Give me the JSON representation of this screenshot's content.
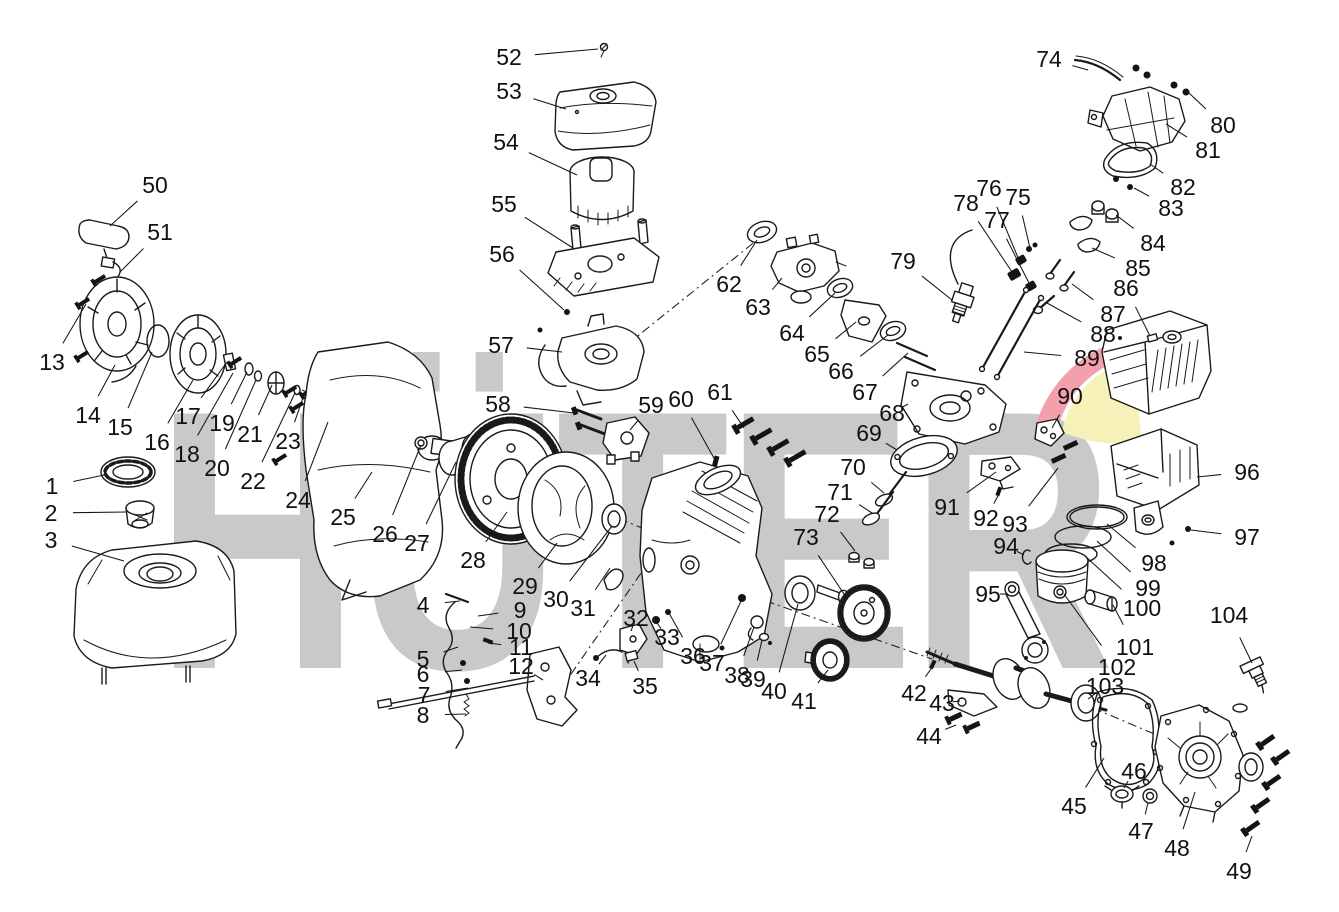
{
  "figure_type": "exploded-parts-diagram",
  "subject": "single-cylinder gasoline engine",
  "background": "#ffffff",
  "watermark": {
    "text": "HÜTER",
    "color": "#c9c9c9",
    "logo_red": "#f2a0ac",
    "logo_yellow": "#f6f1b8"
  },
  "diagram": {
    "line_color": "#1a1a1a",
    "label_font_size": 23,
    "part_count": 104,
    "parts": [
      {
        "num": "1",
        "label": [
          52,
          486
        ],
        "target": [
          104,
          475
        ]
      },
      {
        "num": "2",
        "label": [
          51,
          513
        ],
        "target": [
          127,
          512
        ]
      },
      {
        "num": "3",
        "label": [
          51,
          540
        ],
        "target": [
          124,
          561
        ]
      },
      {
        "num": "4",
        "label": [
          423,
          605
        ],
        "target": [
          460,
          601
        ]
      },
      {
        "num": "5",
        "label": [
          423,
          659
        ],
        "target": [
          458,
          647
        ]
      },
      {
        "num": "6",
        "label": [
          423,
          674
        ],
        "target": [
          462,
          670
        ]
      },
      {
        "num": "7",
        "label": [
          424,
          695
        ],
        "target": [
          468,
          688
        ]
      },
      {
        "num": "8",
        "label": [
          423,
          715
        ],
        "target": [
          466,
          714
        ]
      },
      {
        "num": "9",
        "label": [
          520,
          610
        ],
        "target": [
          478,
          616
        ]
      },
      {
        "num": "10",
        "label": [
          519,
          631
        ],
        "target": [
          470,
          627
        ]
      },
      {
        "num": "11",
        "label": [
          521,
          647
        ],
        "target": [
          488,
          643
        ]
      },
      {
        "num": "12",
        "label": [
          521,
          666
        ],
        "target": [
          543,
          680
        ]
      },
      {
        "num": "13",
        "label": [
          52,
          362
        ],
        "target": [
          86,
          304
        ]
      },
      {
        "num": "14",
        "label": [
          88,
          415
        ],
        "target": [
          115,
          365
        ]
      },
      {
        "num": "15",
        "label": [
          120,
          427
        ],
        "target": [
          152,
          352
        ]
      },
      {
        "num": "16",
        "label": [
          157,
          442
        ],
        "target": [
          193,
          380
        ]
      },
      {
        "num": "17",
        "label": [
          188,
          416
        ],
        "target": [
          227,
          362
        ]
      },
      {
        "num": "18",
        "label": [
          187,
          454
        ],
        "target": [
          233,
          373
        ]
      },
      {
        "num": "19",
        "label": [
          222,
          423
        ],
        "target": [
          247,
          372
        ]
      },
      {
        "num": "20",
        "label": [
          217,
          468
        ],
        "target": [
          256,
          380
        ]
      },
      {
        "num": "21",
        "label": [
          250,
          434
        ],
        "target": [
          272,
          385
        ]
      },
      {
        "num": "22",
        "label": [
          253,
          481
        ],
        "target": [
          295,
          393
        ]
      },
      {
        "num": "23",
        "label": [
          288,
          441
        ],
        "target": [
          305,
          392
        ]
      },
      {
        "num": "24",
        "label": [
          298,
          500
        ],
        "target": [
          328,
          422
        ]
      },
      {
        "num": "25",
        "label": [
          343,
          517
        ],
        "target": [
          372,
          472
        ]
      },
      {
        "num": "26",
        "label": [
          385,
          534
        ],
        "target": [
          421,
          445
        ]
      },
      {
        "num": "27",
        "label": [
          417,
          543
        ],
        "target": [
          456,
          462
        ]
      },
      {
        "num": "28",
        "label": [
          473,
          560
        ],
        "target": [
          507,
          512
        ]
      },
      {
        "num": "29",
        "label": [
          525,
          586
        ],
        "target": [
          557,
          543
        ]
      },
      {
        "num": "30",
        "label": [
          556,
          599
        ],
        "target": [
          612,
          526
        ]
      },
      {
        "num": "31",
        "label": [
          583,
          608
        ],
        "target": [
          610,
          568
        ]
      },
      {
        "num": "32",
        "label": [
          636,
          618
        ],
        "target": [
          631,
          631
        ]
      },
      {
        "num": "33",
        "label": [
          667,
          637
        ],
        "target": [
          657,
          623
        ]
      },
      {
        "num": "34",
        "label": [
          588,
          678
        ],
        "target": [
          606,
          655
        ]
      },
      {
        "num": "35",
        "label": [
          645,
          686
        ],
        "target": [
          634,
          661
        ]
      },
      {
        "num": "36",
        "label": [
          693,
          656
        ],
        "target": [
          669,
          613
        ]
      },
      {
        "num": "37",
        "label": [
          712,
          663
        ],
        "target": [
          742,
          599
        ]
      },
      {
        "num": "38",
        "label": [
          737,
          675
        ],
        "target": [
          754,
          627
        ]
      },
      {
        "num": "39",
        "label": [
          753,
          679
        ],
        "target": [
          762,
          640
        ]
      },
      {
        "num": "40",
        "label": [
          774,
          691
        ],
        "target": [
          798,
          604
        ]
      },
      {
        "num": "41",
        "label": [
          804,
          701
        ],
        "target": [
          828,
          670
        ]
      },
      {
        "num": "42",
        "label": [
          914,
          693
        ],
        "target": [
          933,
          666
        ]
      },
      {
        "num": "43",
        "label": [
          942,
          703
        ],
        "target": [
          960,
          701
        ]
      },
      {
        "num": "44",
        "label": [
          929,
          736
        ],
        "target": [
          956,
          725
        ]
      },
      {
        "num": "45",
        "label": [
          1074,
          806
        ],
        "target": [
          1104,
          758
        ]
      },
      {
        "num": "46",
        "label": [
          1134,
          771
        ],
        "target": [
          1124,
          788
        ]
      },
      {
        "num": "47",
        "label": [
          1141,
          831
        ],
        "target": [
          1148,
          803
        ]
      },
      {
        "num": "48",
        "label": [
          1177,
          848
        ],
        "target": [
          1195,
          792
        ]
      },
      {
        "num": "49",
        "label": [
          1239,
          871
        ],
        "target": [
          1252,
          836
        ]
      },
      {
        "num": "50",
        "label": [
          155,
          185
        ],
        "target": [
          110,
          226
        ]
      },
      {
        "num": "51",
        "label": [
          160,
          232
        ],
        "target": [
          120,
          272
        ]
      },
      {
        "num": "52",
        "label": [
          509,
          57
        ],
        "target": [
          598,
          49
        ]
      },
      {
        "num": "53",
        "label": [
          509,
          91
        ],
        "target": [
          566,
          109
        ]
      },
      {
        "num": "54",
        "label": [
          506,
          142
        ],
        "target": [
          577,
          175
        ]
      },
      {
        "num": "55",
        "label": [
          504,
          204
        ],
        "target": [
          573,
          248
        ]
      },
      {
        "num": "56",
        "label": [
          502,
          254
        ],
        "target": [
          564,
          310
        ]
      },
      {
        "num": "57",
        "label": [
          501,
          345
        ],
        "target": [
          562,
          352
        ]
      },
      {
        "num": "58",
        "label": [
          498,
          404
        ],
        "target": [
          574,
          413
        ]
      },
      {
        "num": "59",
        "label": [
          651,
          405
        ],
        "target": [
          630,
          430
        ]
      },
      {
        "num": "60",
        "label": [
          681,
          399
        ],
        "target": [
          715,
          460
        ]
      },
      {
        "num": "61",
        "label": [
          720,
          392
        ],
        "target": [
          744,
          428
        ]
      },
      {
        "num": "62",
        "label": [
          729,
          284
        ],
        "target": [
          757,
          240
        ]
      },
      {
        "num": "63",
        "label": [
          758,
          307
        ],
        "target": [
          782,
          278
        ]
      },
      {
        "num": "64",
        "label": [
          792,
          333
        ],
        "target": [
          835,
          293
        ]
      },
      {
        "num": "65",
        "label": [
          817,
          354
        ],
        "target": [
          856,
          322
        ]
      },
      {
        "num": "66",
        "label": [
          841,
          371
        ],
        "target": [
          888,
          335
        ]
      },
      {
        "num": "67",
        "label": [
          865,
          392
        ],
        "target": [
          908,
          353
        ]
      },
      {
        "num": "68",
        "label": [
          892,
          413
        ],
        "target": [
          908,
          404
        ]
      },
      {
        "num": "69",
        "label": [
          869,
          433
        ],
        "target": [
          897,
          450
        ]
      },
      {
        "num": "70",
        "label": [
          853,
          467
        ],
        "target": [
          884,
          493
        ]
      },
      {
        "num": "71",
        "label": [
          840,
          492
        ],
        "target": [
          872,
          513
        ]
      },
      {
        "num": "72",
        "label": [
          827,
          514
        ],
        "target": [
          855,
          551
        ]
      },
      {
        "num": "73",
        "label": [
          806,
          537
        ],
        "target": [
          846,
          597
        ]
      },
      {
        "num": "74",
        "label": [
          1049,
          59
        ],
        "target": [
          1088,
          70
        ]
      },
      {
        "num": "75",
        "label": [
          1018,
          197
        ],
        "target": [
          1030,
          248
        ]
      },
      {
        "num": "76",
        "label": [
          989,
          188
        ],
        "target": [
          1019,
          260
        ]
      },
      {
        "num": "77",
        "label": [
          997,
          220
        ],
        "target": [
          1029,
          283
        ]
      },
      {
        "num": "78",
        "label": [
          966,
          203
        ],
        "target": [
          1012,
          272
        ]
      },
      {
        "num": "79",
        "label": [
          903,
          261
        ],
        "target": [
          952,
          300
        ]
      },
      {
        "num": "80",
        "label": [
          1223,
          125
        ],
        "target": [
          1189,
          93
        ]
      },
      {
        "num": "81",
        "label": [
          1208,
          150
        ],
        "target": [
          1166,
          124
        ]
      },
      {
        "num": "82",
        "label": [
          1183,
          187
        ],
        "target": [
          1150,
          164
        ]
      },
      {
        "num": "83",
        "label": [
          1171,
          208
        ],
        "target": [
          1134,
          188
        ]
      },
      {
        "num": "84",
        "label": [
          1153,
          243
        ],
        "target": [
          1116,
          215
        ]
      },
      {
        "num": "85",
        "label": [
          1138,
          268
        ],
        "target": [
          1092,
          248
        ]
      },
      {
        "num": "86",
        "label": [
          1126,
          288
        ],
        "target": [
          1150,
          336
        ]
      },
      {
        "num": "87",
        "label": [
          1113,
          314
        ],
        "target": [
          1072,
          284
        ]
      },
      {
        "num": "88",
        "label": [
          1103,
          334
        ],
        "target": [
          1047,
          303
        ]
      },
      {
        "num": "89",
        "label": [
          1087,
          358
        ],
        "target": [
          1024,
          352
        ]
      },
      {
        "num": "90",
        "label": [
          1070,
          396
        ],
        "target": [
          1052,
          428
        ]
      },
      {
        "num": "91",
        "label": [
          947,
          507
        ],
        "target": [
          996,
          472
        ]
      },
      {
        "num": "92",
        "label": [
          986,
          518
        ],
        "target": [
          999,
          494
        ]
      },
      {
        "num": "93",
        "label": [
          1015,
          524
        ],
        "target": [
          1058,
          468
        ]
      },
      {
        "num": "94",
        "label": [
          1006,
          546
        ],
        "target": [
          1024,
          555
        ]
      },
      {
        "num": "95",
        "label": [
          988,
          594
        ],
        "target": [
          1008,
          594
        ]
      },
      {
        "num": "96",
        "label": [
          1247,
          472
        ],
        "target": [
          1197,
          477
        ]
      },
      {
        "num": "97",
        "label": [
          1247,
          537
        ],
        "target": [
          1191,
          530
        ]
      },
      {
        "num": "98",
        "label": [
          1154,
          563
        ],
        "target": [
          1107,
          524
        ]
      },
      {
        "num": "99",
        "label": [
          1148,
          588
        ],
        "target": [
          1097,
          541
        ]
      },
      {
        "num": "100",
        "label": [
          1142,
          608
        ],
        "target": [
          1085,
          556
        ]
      },
      {
        "num": "101",
        "label": [
          1135,
          647
        ],
        "target": [
          1113,
          605
        ]
      },
      {
        "num": "102",
        "label": [
          1117,
          667
        ],
        "target": [
          1064,
          594
        ]
      },
      {
        "num": "103",
        "label": [
          1105,
          686
        ],
        "target": [
          1088,
          699
        ]
      },
      {
        "num": "104",
        "label": [
          1229,
          615
        ],
        "target": [
          1252,
          663
        ]
      }
    ],
    "axes": [
      [
        [
          302,
          390
        ],
        [
          652,
          532
        ]
      ],
      [
        [
          598,
          368
        ],
        [
          762,
          236
        ]
      ],
      [
        [
          560,
          690
        ],
        [
          718,
          462
        ]
      ],
      [
        [
          640,
          557
        ],
        [
          932,
          659
        ]
      ],
      [
        [
          1093,
          708
        ],
        [
          1237,
          769
        ]
      ]
    ]
  }
}
